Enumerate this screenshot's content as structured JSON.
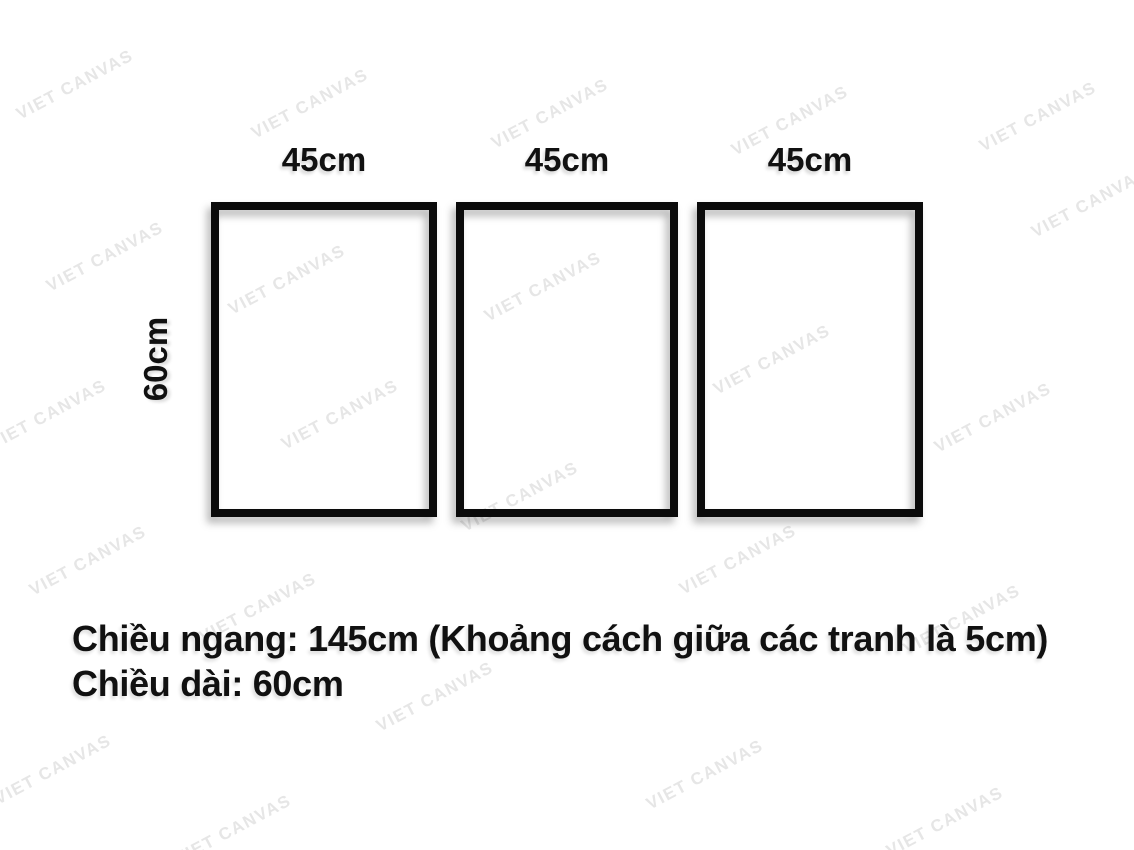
{
  "colors": {
    "ink": "#111111",
    "frame_border": "#0b0b0b",
    "watermark": "#e6e6e6",
    "background": "#ffffff"
  },
  "watermark": {
    "text": "VIET CANVAS"
  },
  "frames": [
    {
      "width_label": "45cm"
    },
    {
      "width_label": "45cm"
    },
    {
      "width_label": "45cm"
    }
  ],
  "height_label": "60cm",
  "notes": {
    "line1": "Chiều ngang: 145cm (Khoảng cách giữa các tranh là 5cm)",
    "line2": "Chiều dài: 60cm"
  }
}
